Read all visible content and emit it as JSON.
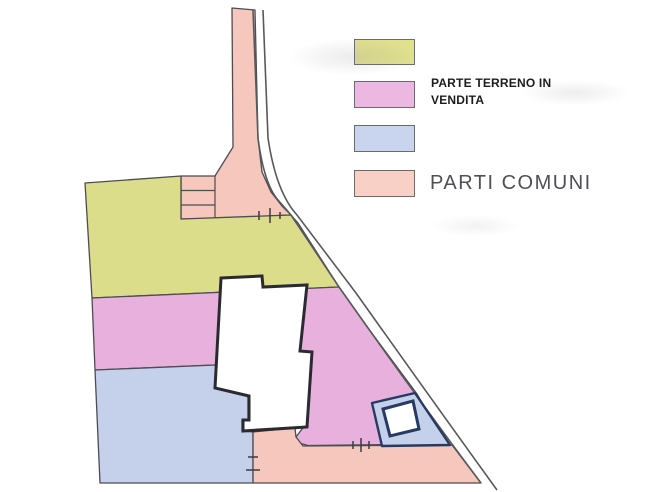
{
  "legend": {
    "items": [
      {
        "id": "terreno-giallo",
        "label": "",
        "color": "#e0e08f"
      },
      {
        "id": "parte-terreno-in-vendita",
        "label": "PARTE TERRENO IN VENDITA",
        "color": "#ecb7e0"
      },
      {
        "id": "terreno-blu",
        "label": "",
        "color": "#c9d4ee"
      },
      {
        "id": "parti-comuni",
        "label": "PARTI COMUNI",
        "color": "#f9d0c5"
      }
    ]
  },
  "colors": {
    "yellow_parcel": "#dcdd8b",
    "sale_parcel": "#e8b0dc",
    "blue_parcel": "#c5d1eb",
    "common_parcel": "#f6c7bc",
    "parcel_outline": "#4c4c52",
    "road_line": "#59595c",
    "tick_line": "#3a3a3f",
    "building_fill": "#ffffff",
    "building_outline": "#2a2a31",
    "pool_plot_fill": "#c5d1eb",
    "pool_outline": "#273a62",
    "page_background": "#ffffff"
  }
}
